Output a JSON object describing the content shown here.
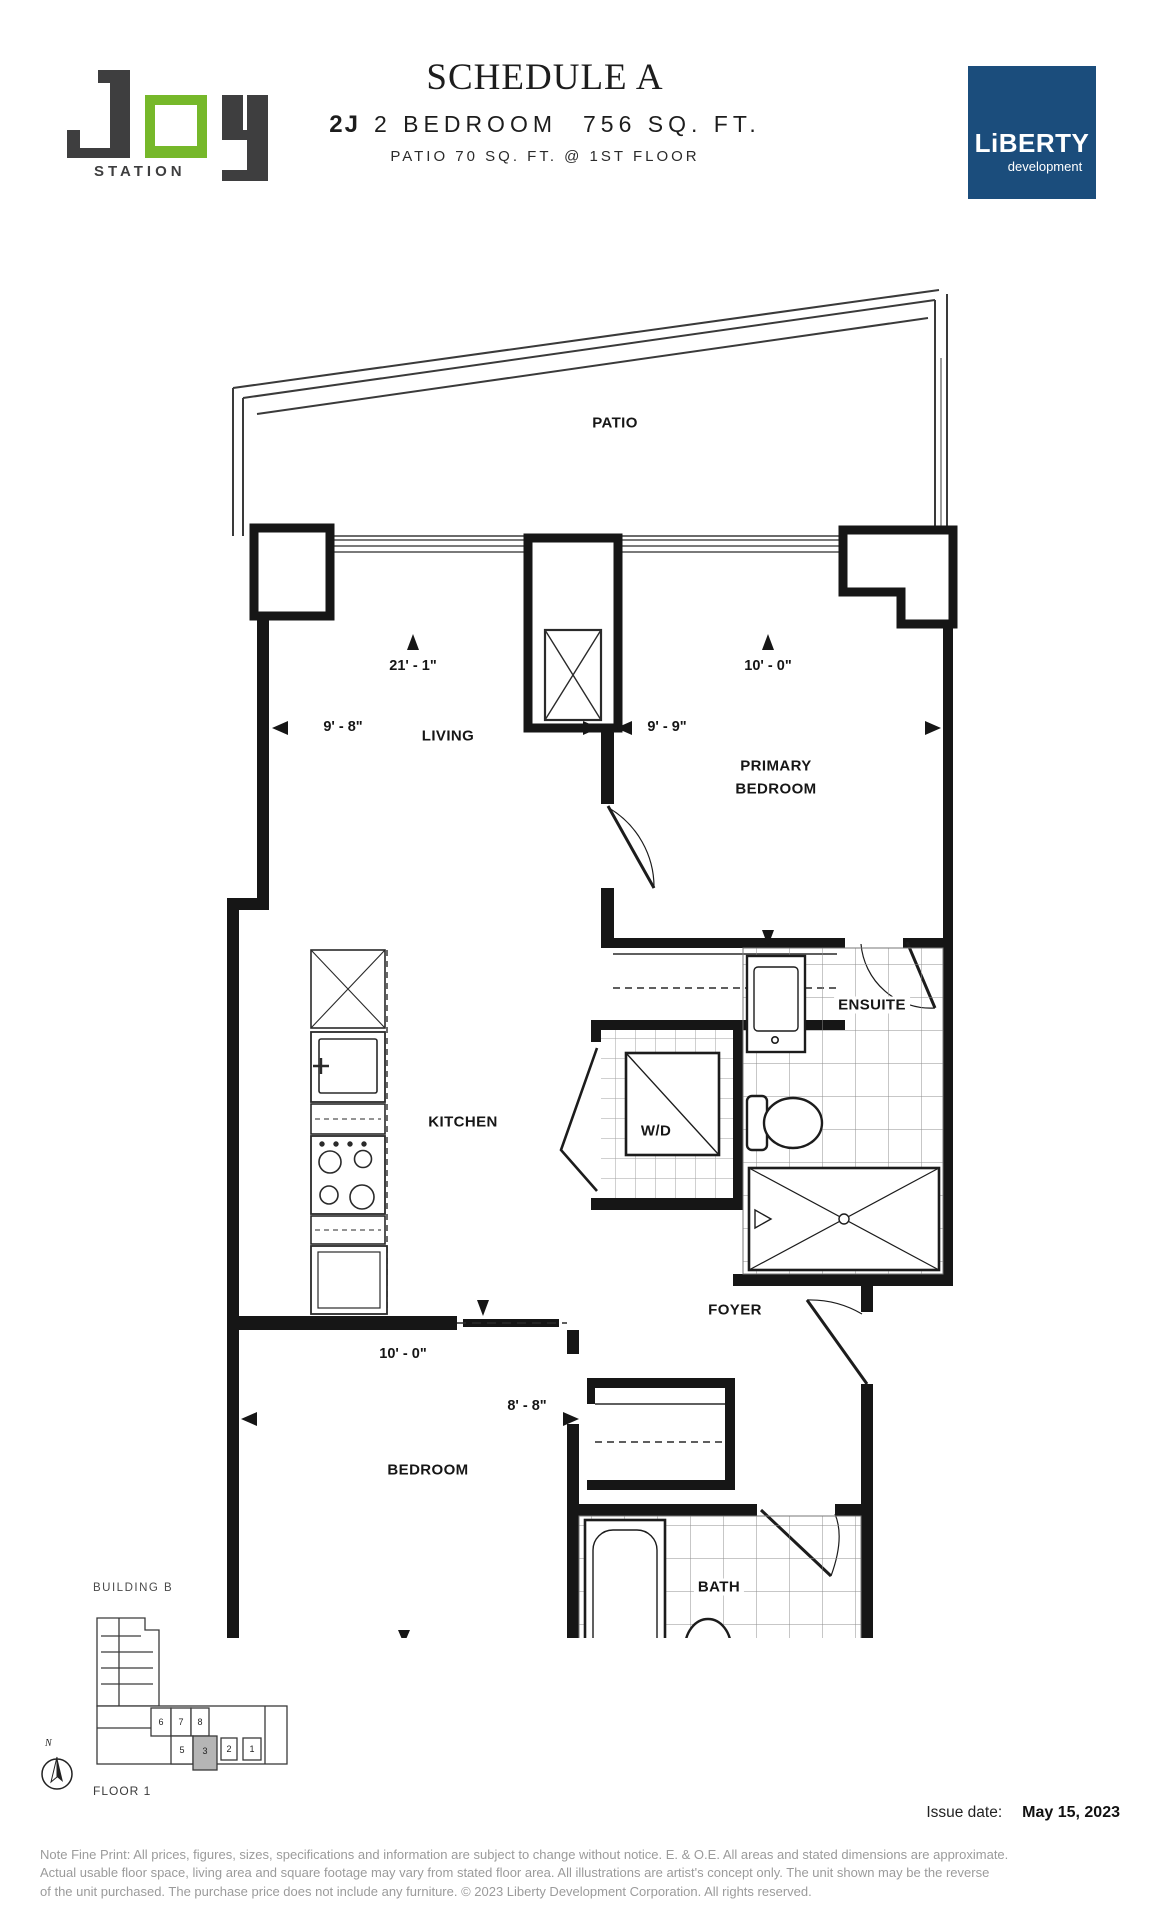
{
  "header": {
    "logo": {
      "brand": "JOY",
      "station": "STATION"
    },
    "schedule_title": "SCHEDULE A",
    "unit_code": "2J",
    "unit_type": "2 BEDROOM",
    "unit_area": "756 SQ. FT.",
    "patio_line": "PATIO 70 SQ. FT. @ 1ST FLOOR",
    "developer": {
      "name": "LiBERTY",
      "tagline": "development"
    }
  },
  "plan": {
    "labels": {
      "patio": "PATIO",
      "living": "LIVING",
      "primary_bedroom": "PRIMARY BEDROOM",
      "kitchen": "KITCHEN",
      "wd": "W/D",
      "ensuite": "ENSUITE",
      "foyer": "FOYER",
      "bedroom": "BEDROOM",
      "bath": "BATH"
    },
    "dims": {
      "living_width": "21' - 1\"",
      "primary_width": "10' - 0\"",
      "living_depth": "9' - 8\"",
      "primary_depth": "9' - 9\"",
      "bedroom_width": "10' - 0\"",
      "bedroom_depth": "8' - 8\""
    }
  },
  "keyplan": {
    "building": "BUILDING B",
    "floor": "FLOOR 1",
    "compass_label": "N",
    "units": [
      "6",
      "7",
      "8",
      "5",
      "3",
      "2",
      "1"
    ],
    "highlighted_unit": "3"
  },
  "footer": {
    "issue_label": "Issue date:",
    "issue_date": "May 15, 2023",
    "fine_print_lines": [
      "Note Fine Print:  All prices, figures, sizes, specifications and information are subject to change without notice.  E. & O.E.  All areas and stated dimensions are approximate.",
      "Actual usable floor space, living area and square footage may vary from stated floor area.  All illustrations are artist's concept only.  The unit shown may be the reverse",
      "of the unit purchased. The purchase price does not include any furniture. © 2023 Liberty Development Corporation. All rights reserved."
    ]
  },
  "colors": {
    "logo_green": "#76B82A",
    "logo_dark": "#3E3E3F",
    "liberty_blue": "#1B4D7C",
    "plan_line": "#161616",
    "keyplan_highlight": "#b5b5b5"
  }
}
